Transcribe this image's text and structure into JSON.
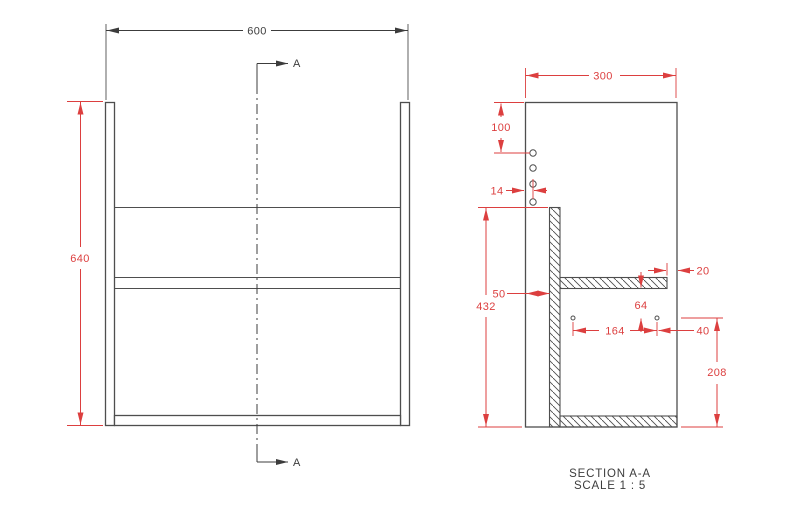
{
  "drawing": {
    "front_view": {
      "width": "600",
      "height": "640",
      "section_arrow": "A"
    },
    "section_view": {
      "depth": "300",
      "top_to_first_hole": "100",
      "hole_to_back": "14",
      "back_panel_offset": "50",
      "back_panel_height": "432",
      "shelf_front_gap": "20",
      "shelf_to_hole": "64",
      "hole_spacing": "164",
      "hole_to_front": "40",
      "hole_to_bottom": "208",
      "caption_title": "SECTION A-A",
      "caption_scale": "SCALE 1 : 5"
    },
    "colors": {
      "dimension_red": "#dc3f3f",
      "line_gray": "#4e4e4e",
      "text_dark": "#3c3c3c",
      "background": "#ffffff"
    }
  }
}
